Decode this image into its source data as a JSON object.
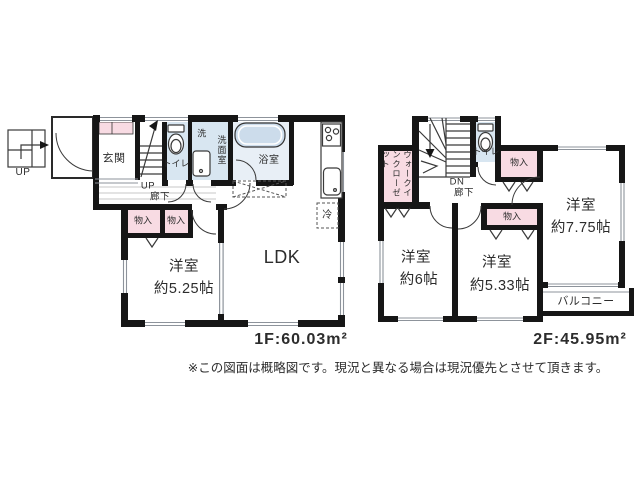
{
  "plan": {
    "f1": {
      "area": "1F:60.03m²",
      "genkan": "玄関",
      "toilet": "トイレ",
      "laundry": "洗",
      "washroom": "洗面室",
      "bath": "浴室",
      "up": "UP",
      "hall": "廊下",
      "porch_up": "UP",
      "storage": "物入",
      "room": "洋室",
      "room_size": "約5.25帖",
      "ldk": "LDK",
      "fridge": "冷"
    },
    "f2": {
      "area": "2F:45.95m²",
      "wic": "ウォークインクローゼット",
      "toilet": "トイレ",
      "dn": "DN",
      "hall": "廊下",
      "storage": "物入",
      "room1": "洋室",
      "room1_size": "約6帖",
      "room2": "洋室",
      "room2_size": "約5.33帖",
      "room3": "洋室",
      "room3_size": "約7.75帖",
      "balcony": "バルコニー"
    },
    "note": "※この図面は概略図です。現況と異なる場合は現況優先とさせて頂きます。",
    "colors": {
      "wall": "#161616",
      "closet_pink": "#f8dbe3",
      "wet_blue": "#d8e6f1",
      "bath_blue": "#e8eff6"
    }
  }
}
